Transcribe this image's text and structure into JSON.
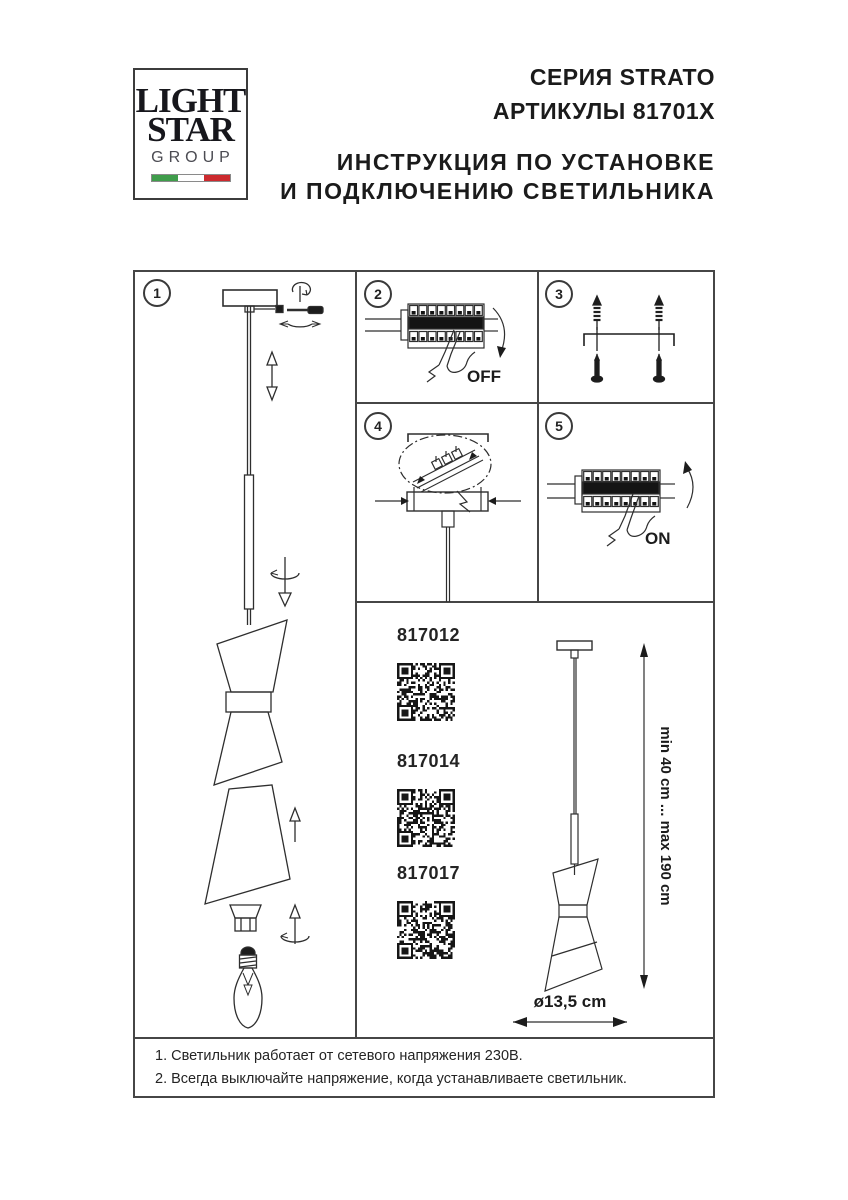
{
  "header": {
    "logo": {
      "line1": "LIGHT",
      "line2": "STAR",
      "line3": "GROUP"
    },
    "series": "СЕРИЯ STRATO",
    "articles": "АРТИКУЛЫ 81701X",
    "title_line1": "ИНСТРУКЦИЯ ПО УСТАНОВКЕ",
    "title_line2": "И ПОДКЛЮЧЕНИЮ СВЕТИЛЬНИКА"
  },
  "steps": {
    "step1": {
      "number": "1"
    },
    "step2": {
      "number": "2",
      "switch_label": "OFF"
    },
    "step3": {
      "number": "3"
    },
    "step4": {
      "number": "4"
    },
    "step5": {
      "number": "5",
      "switch_label": "ON"
    }
  },
  "products": {
    "items": [
      {
        "code": "817012"
      },
      {
        "code": "817014"
      },
      {
        "code": "817017"
      }
    ],
    "diameter_label": "ø13,5 cm",
    "height_label": "min 40 cm ... max 190 cm"
  },
  "footer": {
    "note1": "1. Светильник работает от сетевого напряжения 230В.",
    "note2": "2. Всегда выключайте напряжение, когда устанавливаете светильник."
  },
  "colors": {
    "flag_green": "#3f9d4b",
    "flag_white": "#ffffff",
    "flag_red": "#cc2a2e",
    "line": "#2e2e2e"
  }
}
